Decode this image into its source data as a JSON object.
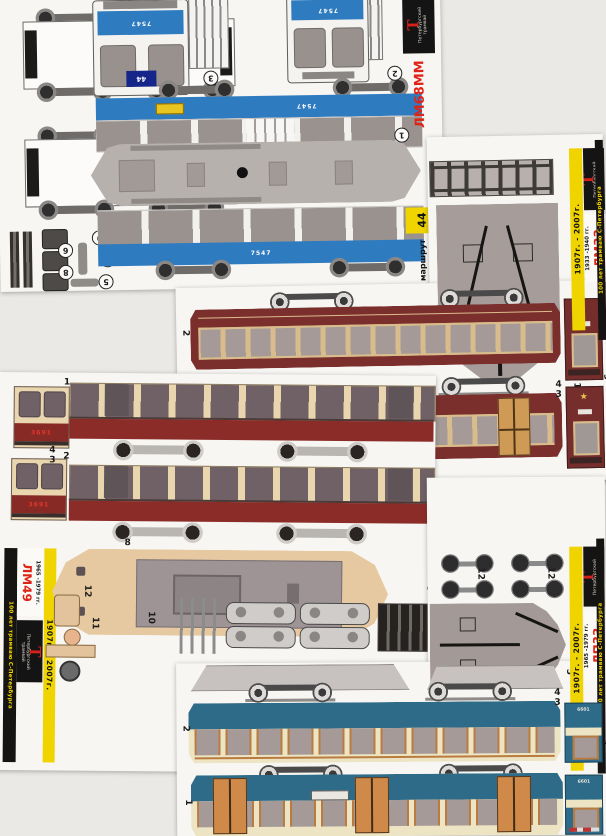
{
  "common": {
    "anniversary": "100 лет трамваю С-Петербурга",
    "jubilee": "1907г. - 2007г.",
    "logo": {
      "big": "Т",
      "line1": "Петербургский",
      "line2": "трамвай"
    },
    "colors": {
      "lm68_blue": "#2e7bbf",
      "lm33_maroon": "#7b2f2d",
      "lm49_red": "#872a26",
      "lm49_cream": "#ead6ae",
      "lp33_teal": "#2e6b89",
      "header_yellow": "#f0d400",
      "header_red": "#e02317"
    }
  },
  "lm68": {
    "model": "ЛМ68ММ",
    "route_number": "44",
    "route_word": "маршрут",
    "car_number": "7547",
    "plate_number": "10",
    "parts": {
      "n1": "1",
      "n2": "2",
      "n3": "3",
      "n4": "4",
      "n5": "5",
      "n6": "6",
      "n7": "7",
      "n8": "8",
      "n9": "9"
    }
  },
  "lm33": {
    "model": "ЛМ33",
    "years": "1933 -1940 гг.",
    "star": "★",
    "parts": {
      "n1": "1",
      "n2": "2",
      "n3": "3",
      "n4": "4",
      "n5": "5",
      "n9": "9",
      "n11": "11"
    }
  },
  "lm49": {
    "model": "ЛМ49",
    "years": "1965 -1979 гг.",
    "car_number": "3691",
    "parts": {
      "n1": "1",
      "n2": "2",
      "n3": "3",
      "n4": "4",
      "n8": "8",
      "n9": "9",
      "n10": "10",
      "n11": "11",
      "n12": "12"
    }
  },
  "lp33": {
    "model": "ЛП33",
    "years": "1965 -1979 гг.",
    "car_number": "6601",
    "parts": {
      "n1": "1",
      "n2": "2",
      "n3": "3",
      "n4": "4",
      "n5": "5",
      "n9": "9",
      "n12": "12"
    }
  }
}
